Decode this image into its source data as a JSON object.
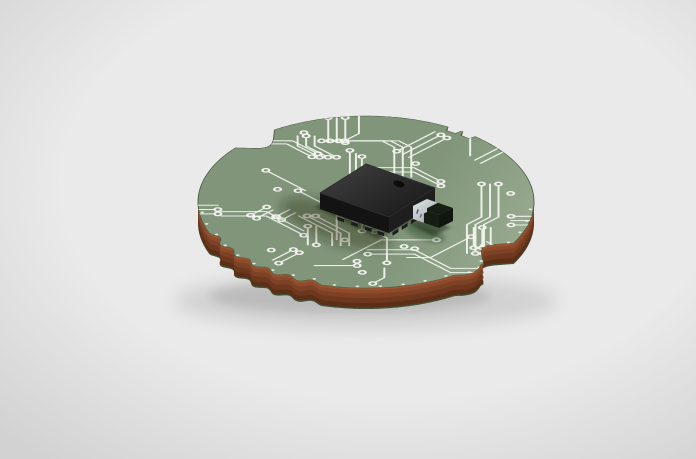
{
  "scene": {
    "type": "3d product render",
    "background": "light gray studio backdrop with soft radial falloff",
    "description": "Isometric 3D render of a circular printed circuit board with scalloped edge notches, white circuit traces with ring-shaped vias, a black integrated-circuit package with a pin-1 dimple and gull-wing leads, and a small SMD component with a silver terminal cap, casting a soft shadow.",
    "objects": [
      {
        "id": "pcb-board",
        "label": "Circular green PCB with copper core edge and scalloped notches"
      },
      {
        "id": "trace-network",
        "label": "White circuit traces with ring-shaped via pads"
      },
      {
        "id": "ic-chip",
        "label": "Black square IC package with pin-1 dimple and leads"
      },
      {
        "id": "smd-component",
        "label": "Small SMD component with silver terminal cap"
      },
      {
        "id": "board-shadow",
        "label": "Soft drop shadow on backdrop"
      }
    ]
  },
  "palette": {
    "background_center": "#eaeaea",
    "background_edge": "#d2d2d2",
    "board_green_dark": "#80957a",
    "board_green_mid": "#9cae93",
    "board_green_light": "#bdc9b3",
    "board_green_sheen": "#e3e8dc",
    "board_edge_line": "#4a5c42",
    "trace_white": "#f4f6f0",
    "copper_light": "#9c5530",
    "copper_dark": "#5d2e17",
    "bottom_rim_green": "#3e5134",
    "chip_top_light": "#3a3a3a",
    "chip_top_dark": "#191919",
    "chip_side_left": "#131313",
    "chip_side_right": "#1e1e1e",
    "lead_gray": "#5f5f5f",
    "lead_dark": "#1b1b1b",
    "pad_dark_green": "#2a3d28",
    "metal_silver_light": "#dfe3e6",
    "metal_silver_dark": "#969ea5",
    "smd_body_dark": "#161d13",
    "smd_end_dark": "#10150e",
    "dimple_dark": "#0c0c0c"
  }
}
